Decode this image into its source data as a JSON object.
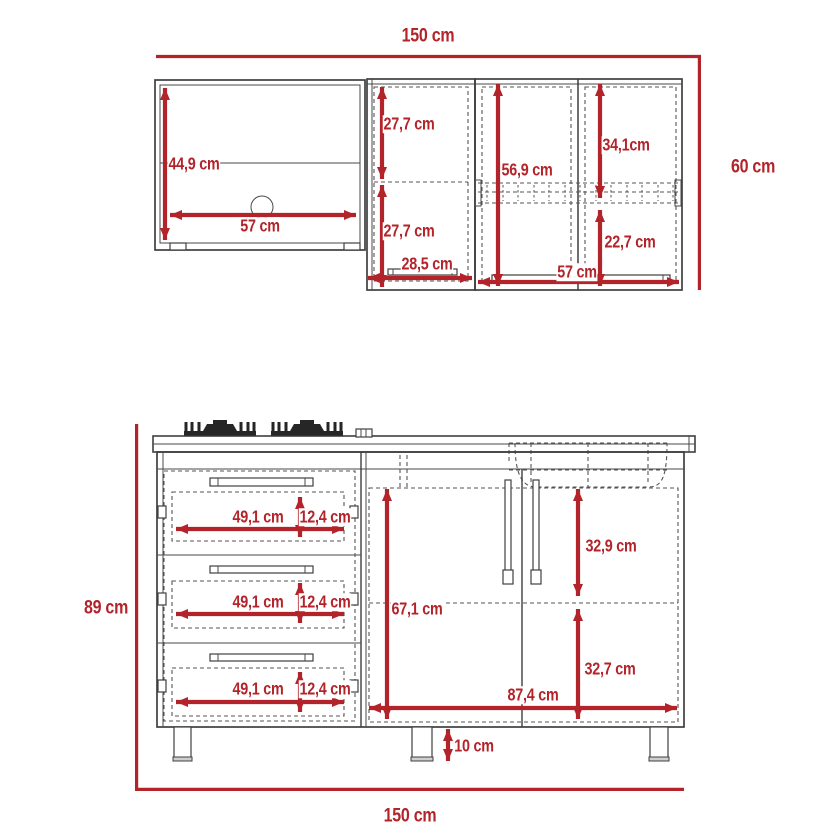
{
  "colors": {
    "dimension_red": "#b3232a",
    "drawing_line": "#3f3f3f",
    "hidden_line": "#555555"
  },
  "upper": {
    "width_total": "150 cm",
    "height_total": "60 cm",
    "cab_left": {
      "height": "44,9 cm",
      "width": "57 cm"
    },
    "cab_mid": {
      "top": "27,7 cm",
      "bottom": "27,7 cm",
      "width": "28,5 cm"
    },
    "cab_right": {
      "height": "56,9 cm",
      "top": "34,1cm",
      "bottom": "22,7 cm",
      "width": "57 cm"
    }
  },
  "lower": {
    "height_total": "89 cm",
    "width_total": "150 cm",
    "drawers": [
      {
        "width": "49,1 cm",
        "height": "12,4 cm"
      },
      {
        "width": "49,1 cm",
        "height": "12,4 cm"
      },
      {
        "width": "49,1 cm",
        "height": "12,4 cm"
      }
    ],
    "doors": {
      "height": "67,1 cm",
      "top": "32,9 cm",
      "bottom": "32,7 cm",
      "width": "87,4 cm"
    },
    "leg_height": "10 cm"
  }
}
